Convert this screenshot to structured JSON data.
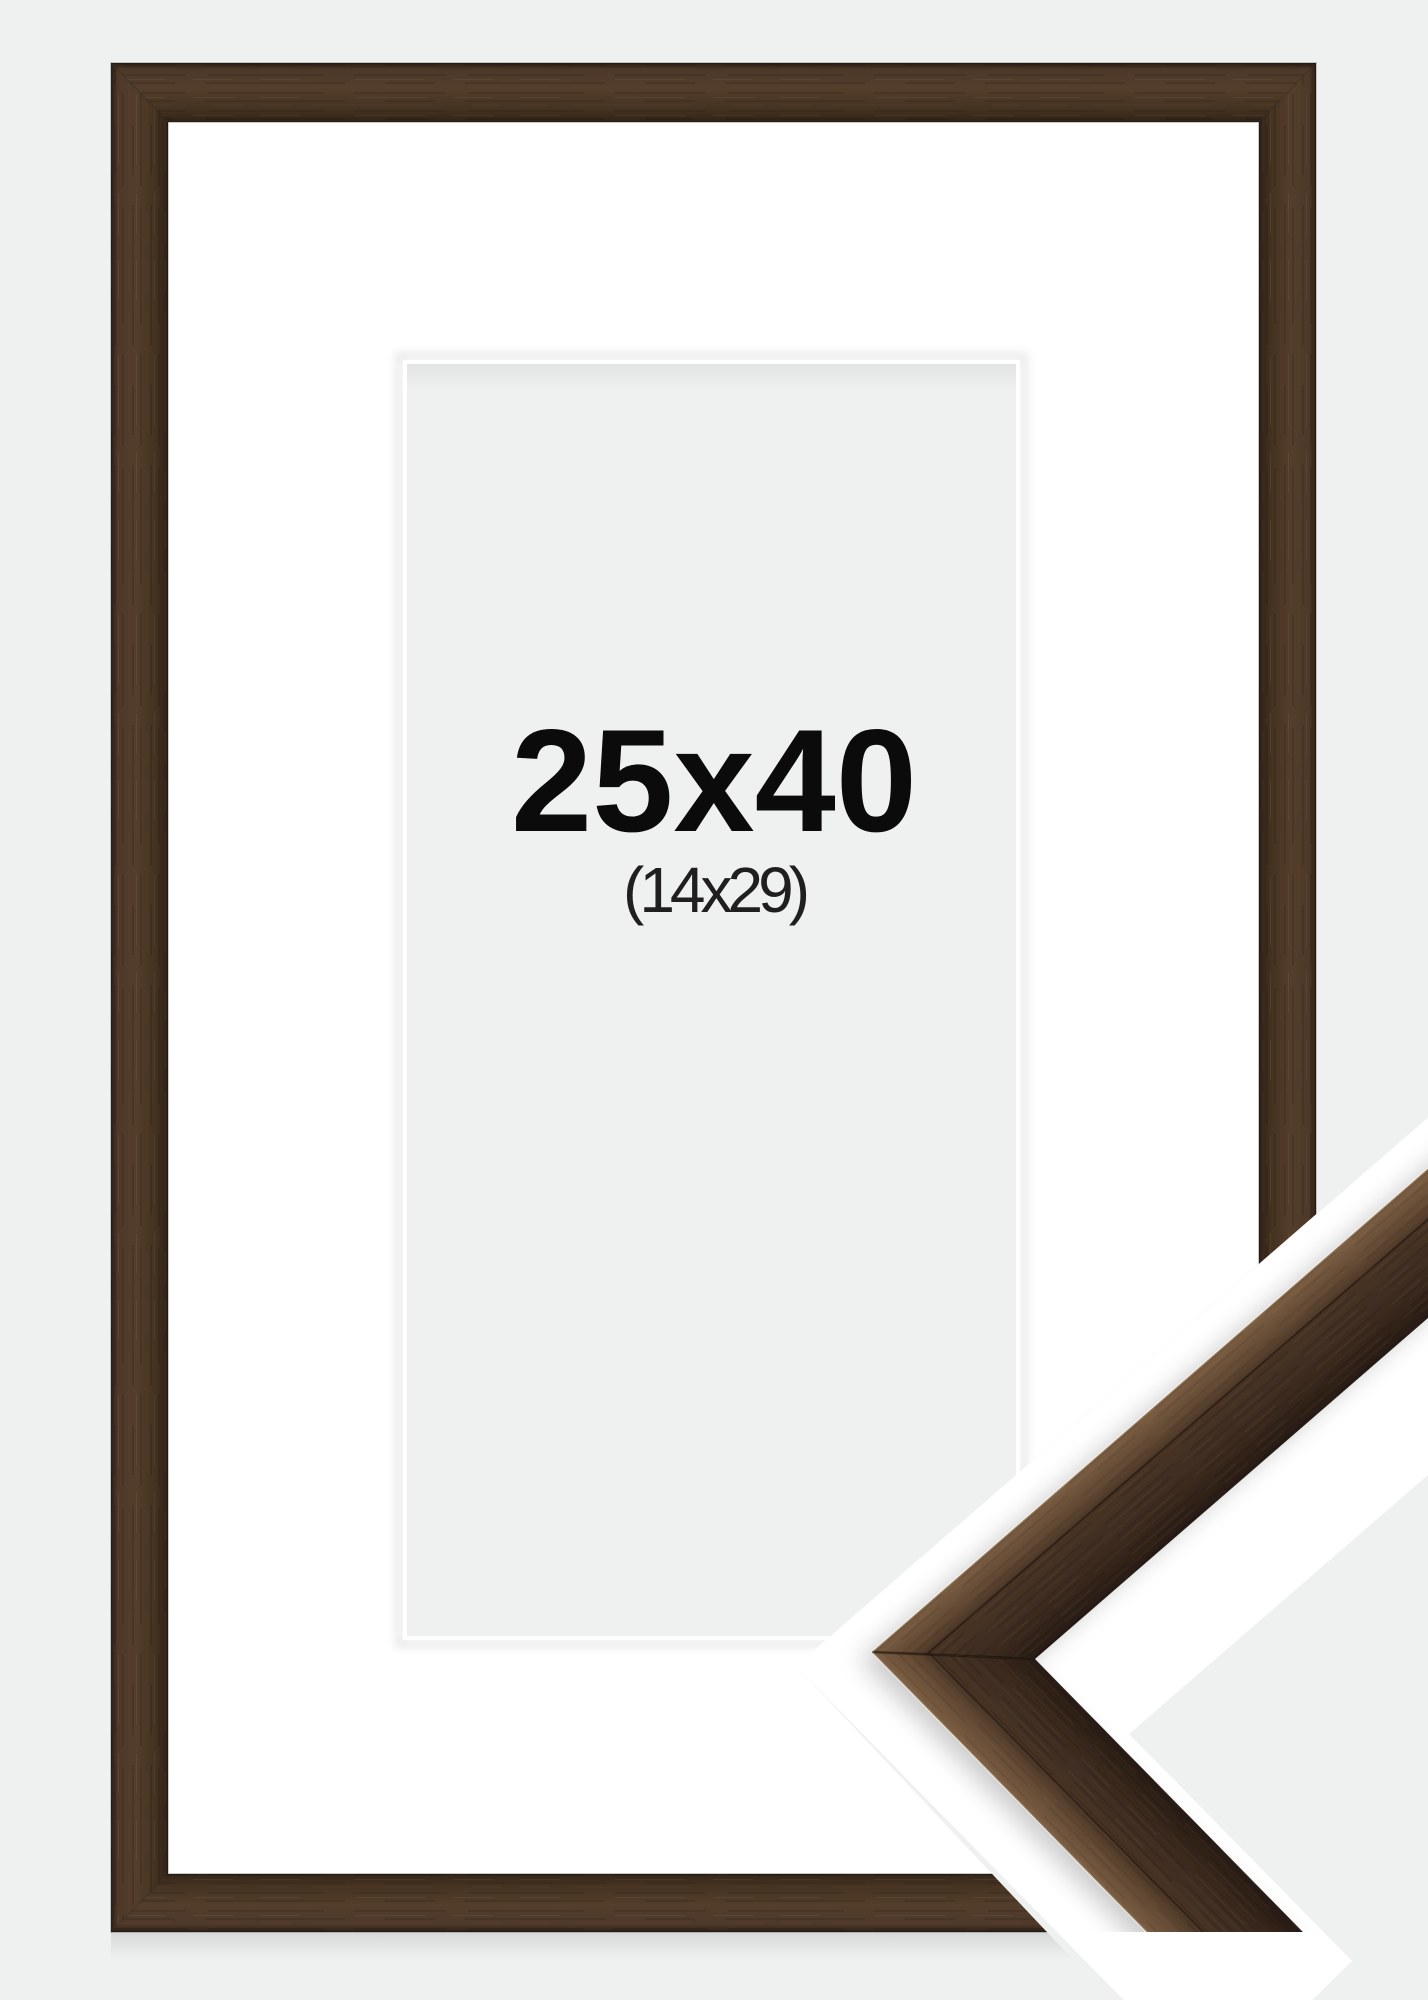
{
  "product": {
    "frame_size_label": "25x40",
    "picture_size_label": "(14x29)"
  },
  "colors": {
    "background": "#eff1f1",
    "mat": "#ffffff",
    "mat_opening": "#eff0f0",
    "wood_dark": "#2c1f16",
    "wood_mid": "#4a3526",
    "wood_light": "#5f4733",
    "wood_top_face": "#7b5e43",
    "corner_sheet": "#ffffff",
    "text": "#0b0b0b"
  }
}
